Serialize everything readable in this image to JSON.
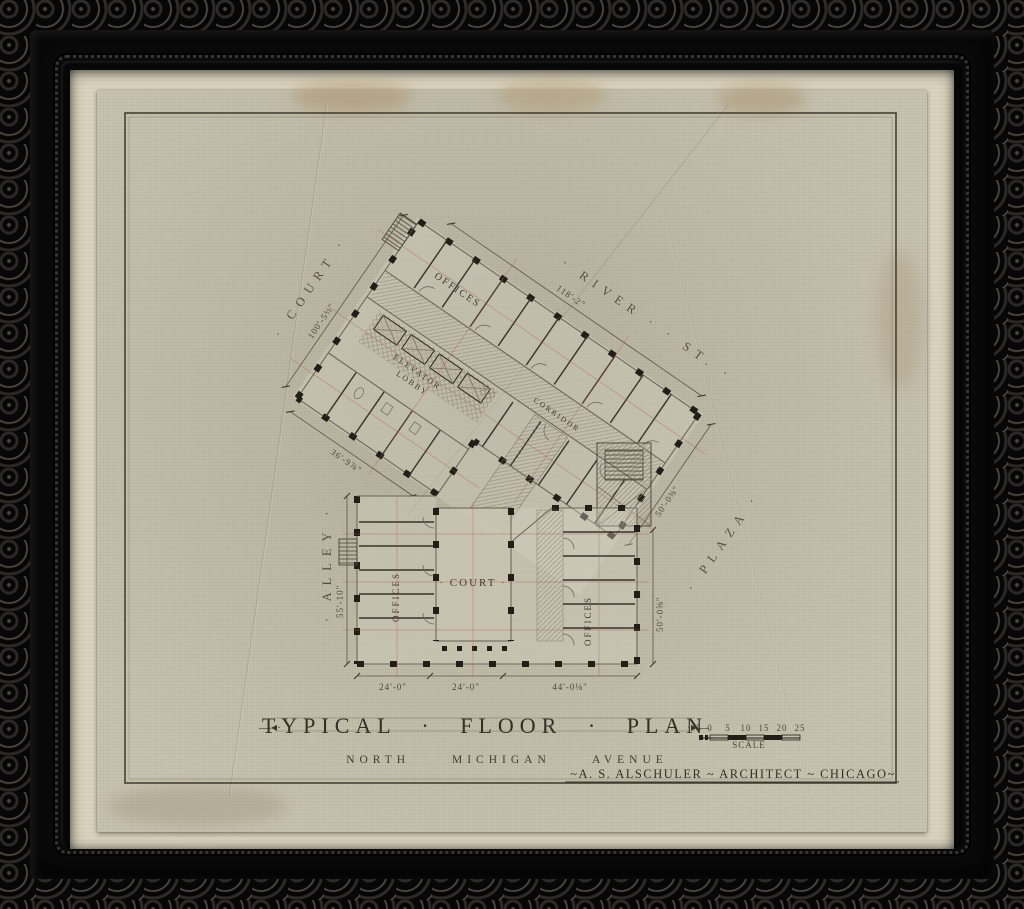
{
  "colors": {
    "frame_black": "#0c0b0b",
    "mat_cream": "#d9d2bd",
    "paper_aged": "#c8c3b0",
    "ink_dark": "#211e18",
    "ink_light": "#6e675a",
    "centerline_red": "#a85a4f",
    "stain_tan": "#a8906a"
  },
  "sheet": {
    "title": "TYPICAL · FLOOR · PLAN",
    "title_ornament_left": "—◂·",
    "title_ornament_right": "·▸—",
    "address_line": "NORTH MICHIGAN AVENUE",
    "architect_line": "~A. S. ALSCHULER ~ ARCHITECT ~ CHICAGO~",
    "scale_label": "SCALE",
    "scale_ticks": [
      "5",
      "0",
      "5",
      "10",
      "15",
      "20",
      "25"
    ]
  },
  "streets": {
    "river": "· RIVER ·  · ST. ·",
    "court": "· COURT ·",
    "alley": "· ALLEY ·",
    "plaza": "· PLAZA ·"
  },
  "rooms": {
    "elevator_line1": "ELEVATOR",
    "elevator_line2": "LOBBY",
    "corridor": "CORRIDOR",
    "court": "· COURT ·",
    "offices_upper": "OFFICES",
    "offices_lower_left": "OFFICES",
    "offices_lower_right": "OFFICES"
  },
  "dimensions": {
    "river_frontage": "118'-2\"",
    "court_frontage": "100'-5½\"",
    "wing_southwest": "36'-9⅞\"",
    "wing_end": "50'-0⅜\"",
    "alley_frontage": "55'-10\"",
    "plaza_frontage": "50'-0⅝\"",
    "bay_left": "24'-0\"",
    "bay_center": "24'-0\"",
    "bay_right": "44'-0⅛\""
  }
}
